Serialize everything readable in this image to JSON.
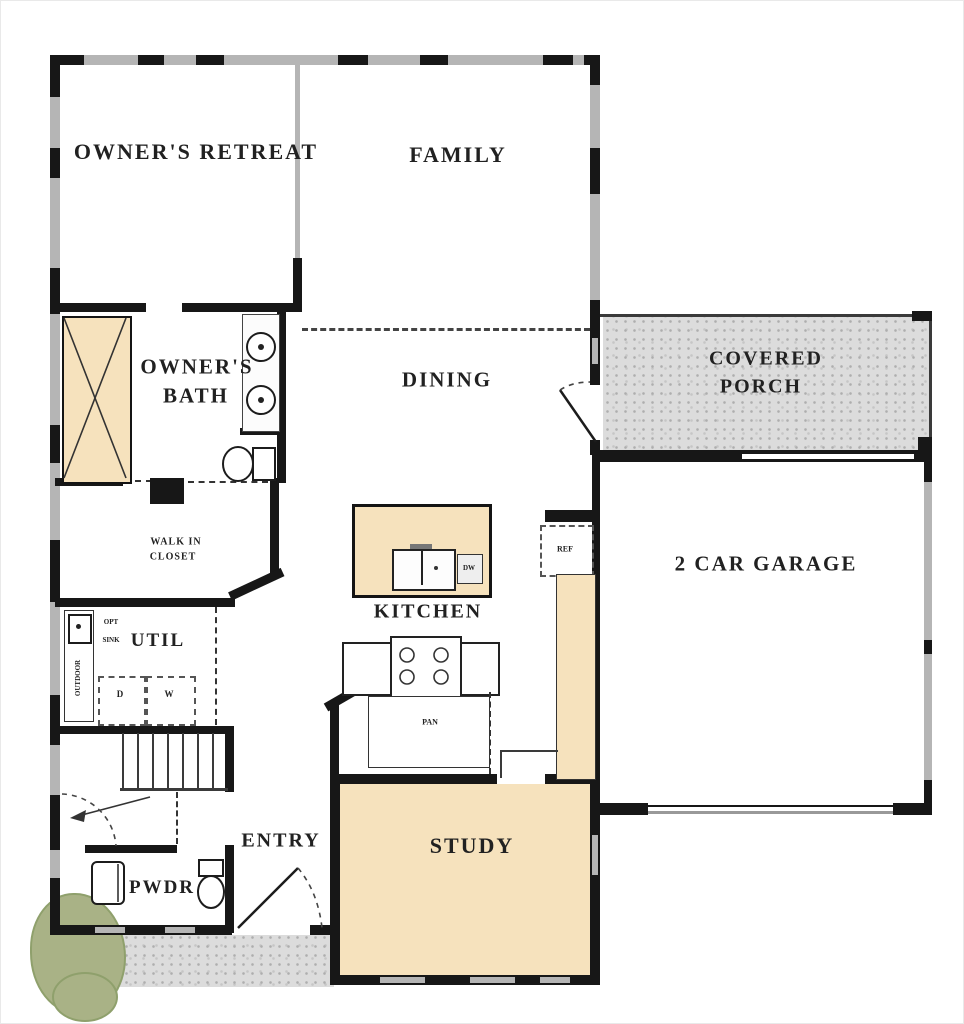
{
  "rooms": {
    "owners_retreat": {
      "label": "OWNER'S RETREAT"
    },
    "family": {
      "label": "FAMILY"
    },
    "owners_bath": {
      "line1": "OWNER'S",
      "line2": "BATH"
    },
    "dining": {
      "label": "DINING"
    },
    "covered_porch": {
      "line1": "COVERED",
      "line2": "PORCH"
    },
    "garage": {
      "label": "2 CAR GARAGE"
    },
    "walk_in_closet": {
      "line1": "WALK IN",
      "line2": "CLOSET"
    },
    "kitchen": {
      "label": "KITCHEN"
    },
    "util": {
      "label": "UTIL"
    },
    "entry": {
      "label": "ENTRY"
    },
    "pwdr": {
      "label": "PWDR"
    },
    "study": {
      "label": "STUDY"
    }
  },
  "fixtures": {
    "refrigerator": "REF",
    "dishwasher": "DW",
    "pantry": "PAN",
    "dryer": "D",
    "washer": "W",
    "opt_sink": {
      "line1": "OPT",
      "line2": "SINK"
    },
    "outdoor": "OUTDOOR"
  },
  "colors": {
    "room_fill_tan": "#f6e2bd",
    "porch_fill_gray": "#dcdcdc",
    "wall_black": "#171717",
    "window_gray": "#b5b5b5",
    "shrub_green": "#a9b286"
  }
}
